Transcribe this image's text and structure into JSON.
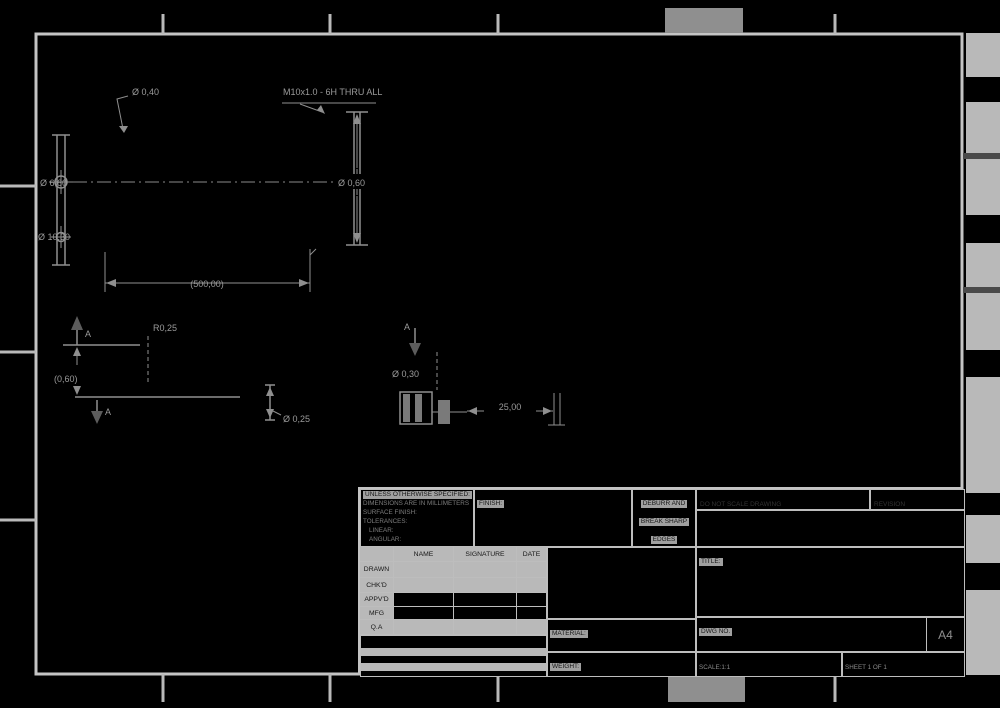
{
  "drawing": {
    "dims": {
      "v1_leader": "Ø 0,40",
      "v1_center": "Ø 6,60",
      "v1_bottom": "Ø 10,30",
      "v2_leader": "M10x1.0 - 6H THRU ALL",
      "v2_height": "Ø 0,60",
      "span": "(500,00)",
      "v3_gap": "(0,60)",
      "v3_radius": "R0,25",
      "v4_dia": "Ø 0,25",
      "v5_dia": "Ø 0,30",
      "v5_width": "25,00",
      "section_letter": "A"
    },
    "colors": {
      "background": "#000000",
      "frame": "#c4c4c4",
      "geometry": "#8f8f8f",
      "dimension_text": "#9a9a9a",
      "fill_band": "#b9b9b9"
    }
  },
  "title_block": {
    "tolerance_lines": [
      "UNLESS OTHERWISE SPECIFIED:",
      "DIMENSIONS ARE IN MILLIMETERS",
      "SURFACE FINISH:",
      "TOLERANCES:",
      "LINEAR:",
      "ANGULAR:"
    ],
    "finish_label": "FINISH:",
    "deburr_lines": [
      "DEBURR AND",
      "BREAK SHARP",
      "EDGES"
    ],
    "do_not_scale": "DO NOT SCALE DRAWING",
    "revision_label": "REVISION",
    "title_label": "TITLE:",
    "name_header": "NAME",
    "signature_header": "SIGNATURE",
    "date_header": "DATE",
    "rows": [
      "DRAWN",
      "CHK'D",
      "APPV'D",
      "MFG",
      "Q.A"
    ],
    "material_label": "MATERIAL:",
    "weight_label": "WEIGHT:",
    "dwg_label": "DWG NO.",
    "sheet_size": "A4",
    "scale_label": "SCALE:1:1",
    "sheet_label": "SHEET 1 OF 1"
  }
}
